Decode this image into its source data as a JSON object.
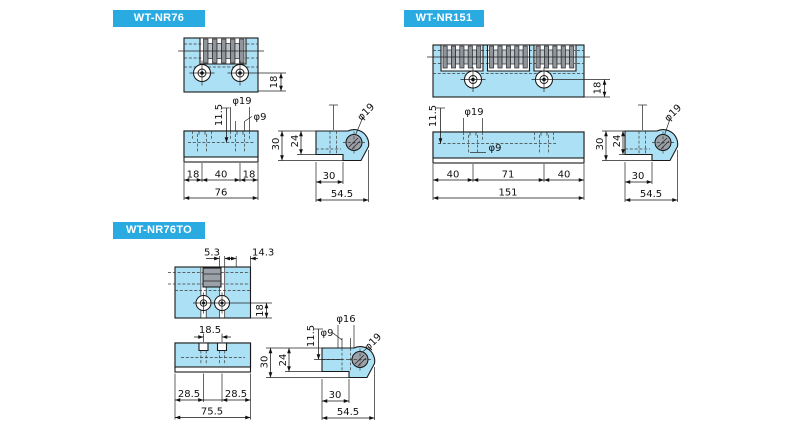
{
  "colors": {
    "banner": "#29ABE2",
    "part_fill": "#ACE0F5",
    "roller_dark": "#8F959B",
    "roller_light": "#BDC2C7",
    "line": "#1a1a1a"
  },
  "panels": [
    {
      "id": "wt-nr76",
      "label": "WT-NR76",
      "dims": {
        "top_h": "18",
        "front_offset": "11.5",
        "front_cbore": "φ19",
        "front_hole": "φ9",
        "front_left": "18",
        "front_mid": "40",
        "front_right": "18",
        "front_total": "76",
        "side_height": "30",
        "side_step": "24",
        "side_roller": "φ19",
        "side_len": "30",
        "side_total": "54.5"
      }
    },
    {
      "id": "wt-nr151",
      "label": "WT-NR151",
      "dims": {
        "top_h": "18",
        "front_offset": "11.5",
        "front_cbore": "φ19",
        "front_hole": "φ9",
        "front_left": "40",
        "front_mid": "71",
        "front_right": "40",
        "front_total": "151",
        "side_height": "30",
        "side_step": "24",
        "side_roller": "φ19",
        "side_len": "30",
        "side_total": "54.5"
      }
    },
    {
      "id": "wt-nr76to",
      "label": "WT-NR76TO",
      "dims": {
        "top_slot": "5.3",
        "top_offset": "14.3",
        "top_h": "18",
        "front_slot_span": "18.5",
        "front_left": "28.5",
        "front_right": "28.5",
        "front_total": "75.5",
        "side_height": "30",
        "side_step": "24",
        "side_offset": "11.5",
        "side_hole": "φ9",
        "side_cbore": "φ16",
        "side_roller": "φ19",
        "side_len": "30",
        "side_total": "54.5"
      }
    }
  ]
}
